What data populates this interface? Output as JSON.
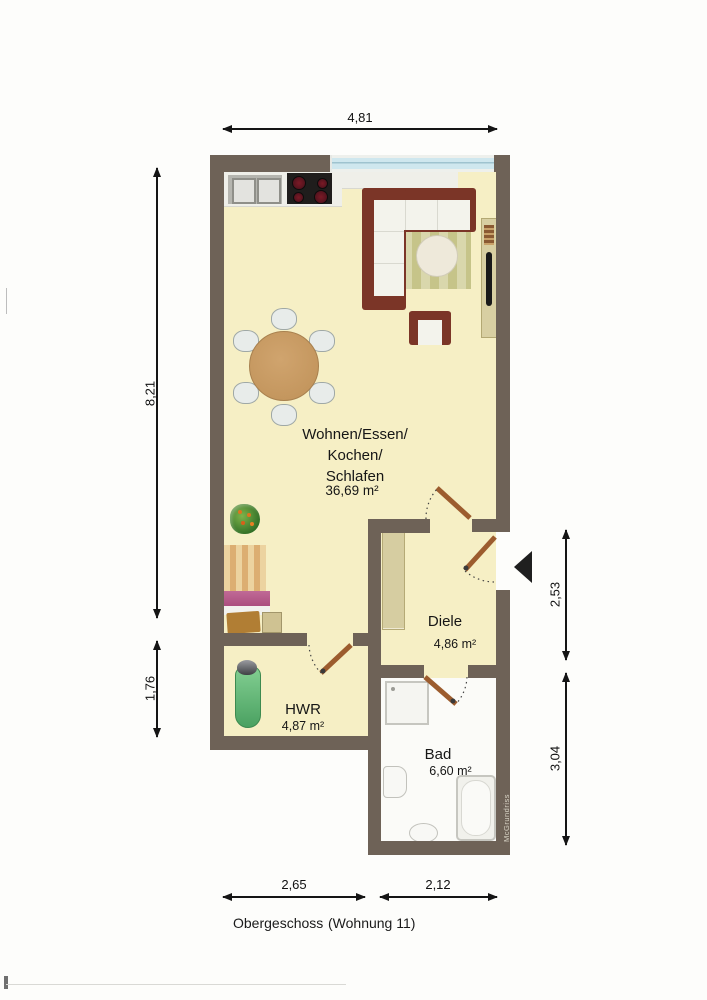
{
  "plan": {
    "rooms": {
      "wohnen": {
        "name_line1": "Wohnen/Essen/",
        "name_line2": "Kochen/",
        "name_line3": "Schlafen",
        "area": "36,69 m²"
      },
      "diele": {
        "name": "Diele",
        "area": "4,86 m²"
      },
      "hwr": {
        "name": "HWR",
        "area": "4,87 m²"
      },
      "bad": {
        "name": "Bad",
        "area": "6,60 m²"
      }
    },
    "dimensions": {
      "top": "4,81",
      "left_upper": "8,21",
      "left_lower": "1,76",
      "right_upper": "2,53",
      "right_lower": "3,04",
      "bottom_left": "2,65",
      "bottom_right": "2,12"
    },
    "caption": {
      "floor": "Obergeschoss",
      "unit": "(Wohnung 11)"
    },
    "watermark": "McGrundriss",
    "furniture": [
      "kitchen-counter",
      "kitchen-sink",
      "cooktop",
      "window",
      "corner-sofa",
      "rug",
      "coffee-table",
      "armchair",
      "sideboard",
      "books",
      "tv-board",
      "dining-table",
      "dining-chair",
      "plant",
      "bed",
      "pillow",
      "blanket",
      "nightstand",
      "wardrobe",
      "ironing-board",
      "iron",
      "shower",
      "toilet",
      "washbasin",
      "bathtub",
      "entrance-arrow",
      "door-leaf",
      "door-swing-arc"
    ],
    "colors": {
      "wall": "#6e6257",
      "floor": "#f6efc5",
      "bath_floor": "#fbfbf8",
      "window_glass": "#cfe7ee",
      "door_leaf": "#9c5c2e",
      "sofa": "#7b3527",
      "dining_table": "#c89a62",
      "ironing_board": "#6cc285",
      "bed_pillow": "#a8497c"
    }
  }
}
